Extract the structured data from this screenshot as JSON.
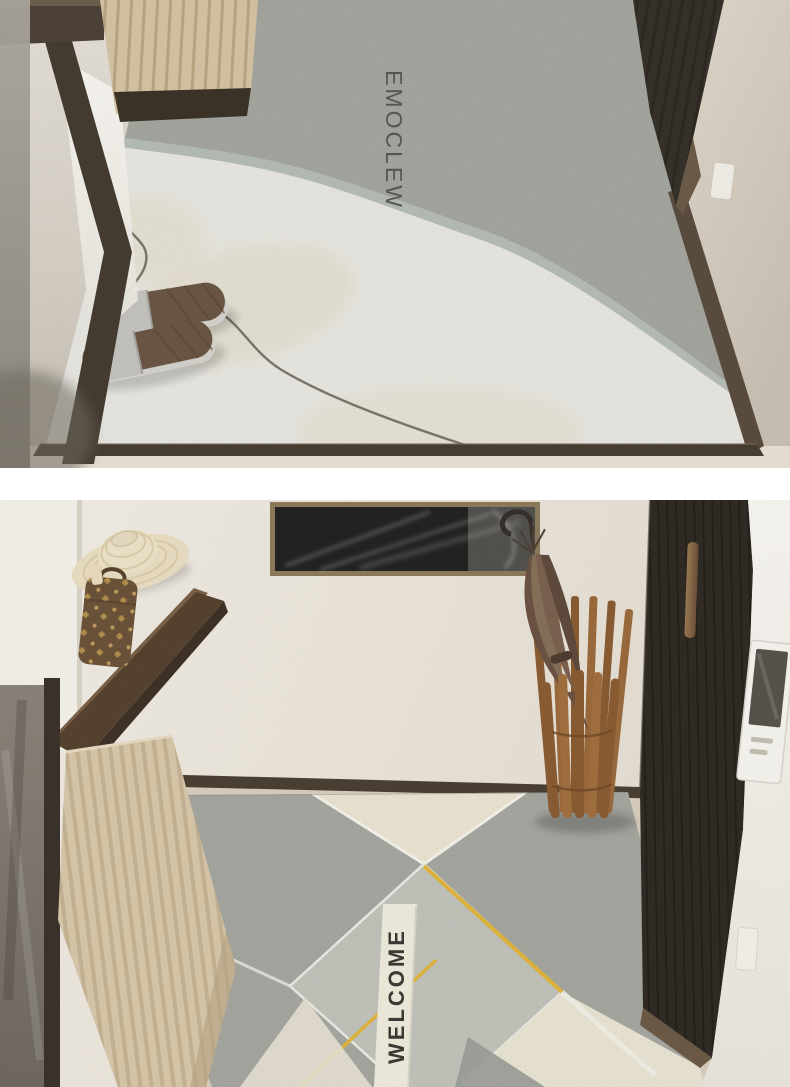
{
  "page": {
    "background_color": "#ffffff",
    "gap_color": "#ffffff"
  },
  "photos": [
    {
      "name": "hallway-doormat-photo-1",
      "mat_text": "WELCOME",
      "palette": {
        "mat_gray": "#a7a9a2",
        "mat_white": "#ecebe5",
        "mat_cream": "#e6dec6",
        "sage_edge": "#b4bcb3",
        "trim_brown": "#5a4c3e",
        "door_dark": "#36312a",
        "wall": "#d6cfc3",
        "slipper_brown": "#6e5947",
        "slipper_strap": "#cbc9c4"
      },
      "objects": [
        "doormat",
        "welcome-print",
        "slippers",
        "scribble-line",
        "entry-door",
        "door-trim",
        "mirror-frame",
        "slatted-cabinet",
        "wall-switch"
      ]
    },
    {
      "name": "hallway-doormat-photo-2",
      "mat_text": "WELCOME",
      "palette": {
        "mat_gray": "#a8aaa3",
        "mat_cream": "#efe8d5",
        "mat_light_gray": "#c5c7bf",
        "accent_yellow": "#e5b93d",
        "ribbon": "#f3f0e2",
        "wall": "#e9e3d9",
        "door_dark": "#302b25",
        "wood_stand": "#9a6a3c",
        "umbrella_brown": "#7a6150",
        "cushion": "#d6c6a9",
        "bag_brown": "#6b5239",
        "hat_straw": "#e7dcc2"
      },
      "objects": [
        "wall-art",
        "display-shelf",
        "straw-hat",
        "monogram-bag",
        "wall-mirror",
        "ribbed-bench",
        "baseboard",
        "doormat",
        "welcome-ribbon",
        "umbrella-stand",
        "umbrella",
        "entry-door",
        "door-handle",
        "intercom-panel",
        "wall-switch"
      ]
    }
  ]
}
